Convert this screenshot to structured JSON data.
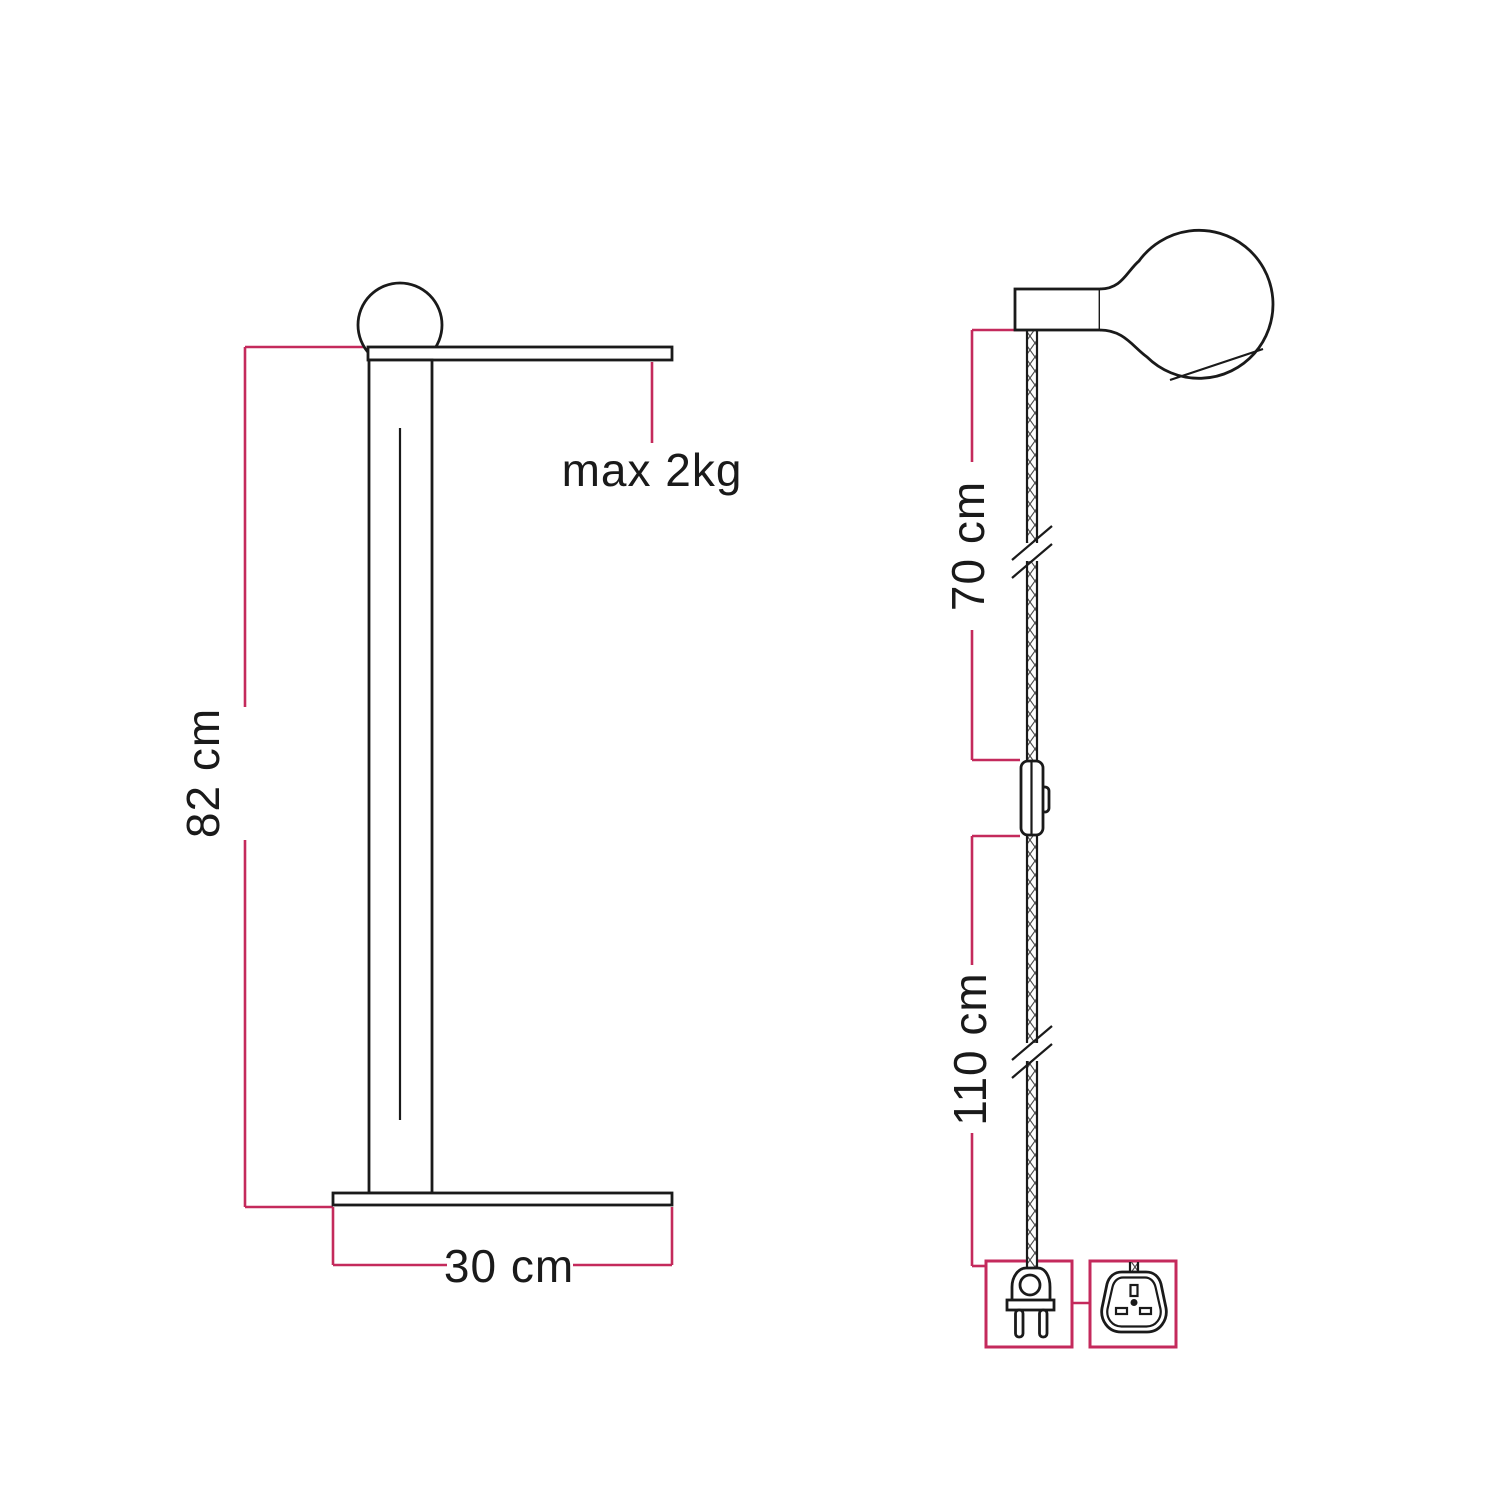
{
  "colors": {
    "ink": "#1a1a1a",
    "accent": "#c42a5c",
    "background": "#ffffff"
  },
  "left_diagram": {
    "name": "floor lamp front view with dimensions",
    "labels": {
      "height": "82 cm",
      "base_width": "30 cm",
      "max_load": "max 2kg"
    },
    "icons": [
      "globe-bulb-icon",
      "lamp-shelf",
      "lamp-pole",
      "lamp-base"
    ]
  },
  "right_diagram": {
    "name": "pendant cable view with dimensions",
    "labels": {
      "cable_upper": "70 cm",
      "cable_lower": "110 cm"
    },
    "icons": [
      "globe-bulb-icon",
      "lamp-holder-icon",
      "braided-cable",
      "cable-break-icon",
      "inline-switch-icon",
      "two-pin-euro-plug-icon",
      "uk-plug-icon"
    ]
  }
}
